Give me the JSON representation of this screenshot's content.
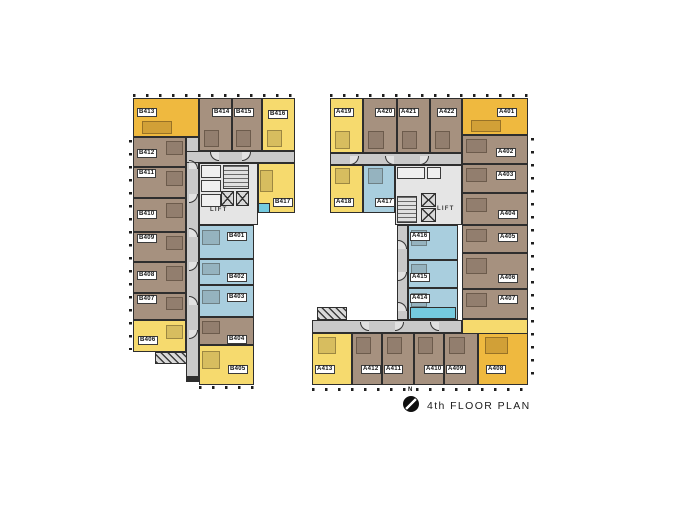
{
  "title": "4th FLOOR PLAN",
  "compass": {
    "label": "N"
  },
  "lift_label": "LIFT",
  "palette": {
    "amber": "#EFB93F",
    "yellow": "#F6DA6E",
    "brown": "#A6917F",
    "blue": "#A9CEDE",
    "cyan": "#74CADF",
    "corridor": "#C9C9C9",
    "core": "#E5E5E5",
    "wall": "#2E2E2E"
  },
  "buildings": [
    {
      "name": "b-wing",
      "corridors": [
        [
          186,
          137,
          13,
          245
        ],
        [
          186,
          151,
          109,
          12
        ]
      ],
      "rooms": [
        {
          "label": "B413",
          "color": "amber",
          "d": "b",
          "rect": [
            133,
            98,
            66,
            39
          ],
          "chip": [
            137,
            108
          ]
        },
        {
          "label": "B414",
          "color": "brown",
          "d": "b",
          "rect": [
            199,
            98,
            33,
            53
          ],
          "chip": [
            212,
            108
          ]
        },
        {
          "label": "B415",
          "color": "brown",
          "d": "b",
          "rect": [
            232,
            98,
            30,
            53
          ],
          "chip": [
            234,
            108
          ]
        },
        {
          "label": "B416",
          "color": "yellow",
          "d": "b",
          "rect": [
            262,
            98,
            33,
            53
          ],
          "chip": [
            268,
            110
          ]
        },
        {
          "label": "B417",
          "color": "yellow",
          "d": "l",
          "rect": [
            258,
            163,
            37,
            50
          ],
          "chip": [
            273,
            198
          ]
        },
        {
          "label": "B412",
          "color": "brown",
          "d": "r",
          "rect": [
            133,
            137,
            53,
            30
          ],
          "chip": [
            137,
            149
          ]
        },
        {
          "label": "B411",
          "color": "brown",
          "d": "r",
          "rect": [
            133,
            167,
            53,
            31
          ],
          "chip": [
            137,
            169
          ]
        },
        {
          "label": "B410",
          "color": "brown",
          "d": "r",
          "rect": [
            133,
            198,
            53,
            34
          ],
          "chip": [
            137,
            210
          ]
        },
        {
          "label": "B409",
          "color": "brown",
          "d": "r",
          "rect": [
            133,
            232,
            53,
            30
          ],
          "chip": [
            137,
            234
          ]
        },
        {
          "label": "B408",
          "color": "brown",
          "d": "r",
          "rect": [
            133,
            262,
            53,
            31
          ],
          "chip": [
            137,
            271
          ]
        },
        {
          "label": "B407",
          "color": "brown",
          "d": "r",
          "rect": [
            133,
            293,
            53,
            27
          ],
          "chip": [
            137,
            295
          ]
        },
        {
          "label": "B406",
          "color": "yellow",
          "d": "r",
          "rect": [
            133,
            320,
            53,
            32
          ],
          "chip": [
            138,
            336
          ]
        },
        {
          "label": "B401",
          "color": "blue",
          "d": "l",
          "rect": [
            199,
            225,
            55,
            34
          ],
          "chip": [
            227,
            232
          ]
        },
        {
          "label": "B402",
          "color": "blue",
          "d": "l",
          "rect": [
            199,
            259,
            55,
            26
          ],
          "chip": [
            227,
            273
          ]
        },
        {
          "label": "B403",
          "color": "blue",
          "d": "l",
          "rect": [
            199,
            285,
            55,
            32
          ],
          "chip": [
            227,
            293
          ]
        },
        {
          "label": "B404",
          "color": "brown",
          "d": "l",
          "rect": [
            199,
            317,
            55,
            28
          ],
          "chip": [
            227,
            335
          ]
        },
        {
          "label": "B405",
          "color": "yellow",
          "d": "l",
          "rect": [
            199,
            345,
            55,
            40
          ],
          "chip": [
            228,
            365
          ]
        }
      ],
      "cores": [
        {
          "rect": [
            199,
            163,
            59,
            62
          ],
          "rooms": [
            [
              201,
              165,
              20,
              13
            ],
            [
              201,
              180,
              20,
              12
            ],
            [
              201,
              194,
              20,
              13
            ]
          ],
          "stairs": [
            [
              223,
              165,
              26,
              24
            ]
          ],
          "lifts": [
            [
              221,
              191,
              13,
              15
            ],
            [
              236,
              191,
              13,
              15
            ]
          ],
          "lift_label_pos": [
            210,
            207
          ]
        }
      ],
      "decorations": [
        {
          "kind": "hatch",
          "rect": [
            155,
            352,
            32,
            12
          ]
        },
        {
          "kind": "cyan",
          "rect": [
            258,
            203,
            12,
            10
          ]
        },
        {
          "kind": "solid-dark",
          "rect": [
            186,
            376,
            13,
            6
          ]
        },
        {
          "kind": "ticks-v",
          "rect": [
            129,
            140,
            3,
            210
          ]
        },
        {
          "kind": "ticks-h",
          "rect": [
            133,
            94,
            162,
            3
          ]
        },
        {
          "kind": "ticks-h",
          "rect": [
            199,
            386,
            55,
            3
          ]
        },
        {
          "kind": "arc",
          "pos": [
            189,
            160
          ],
          "dir": "tr"
        },
        {
          "kind": "arc",
          "pos": [
            189,
            194
          ],
          "dir": "br"
        },
        {
          "kind": "arc",
          "pos": [
            189,
            228
          ],
          "dir": "tr"
        },
        {
          "kind": "arc",
          "pos": [
            189,
            262
          ],
          "dir": "br"
        },
        {
          "kind": "arc",
          "pos": [
            189,
            296
          ],
          "dir": "tr"
        },
        {
          "kind": "arc",
          "pos": [
            189,
            330
          ],
          "dir": "br"
        },
        {
          "kind": "arc",
          "pos": [
            210,
            152
          ],
          "dir": "bl"
        },
        {
          "kind": "arc",
          "pos": [
            242,
            152
          ],
          "dir": "br"
        }
      ]
    },
    {
      "name": "a-wing",
      "corridors": [
        [
          330,
          153,
          132,
          12
        ],
        [
          397,
          225,
          11,
          95
        ],
        [
          312,
          320,
          150,
          13
        ]
      ],
      "rooms": [
        {
          "label": "A419",
          "color": "yellow",
          "d": "b",
          "rect": [
            330,
            98,
            33,
            55
          ],
          "chip": [
            334,
            108
          ]
        },
        {
          "label": "A420",
          "color": "brown",
          "d": "b",
          "rect": [
            363,
            98,
            34,
            55
          ],
          "chip": [
            375,
            108
          ]
        },
        {
          "label": "A421",
          "color": "brown",
          "d": "b",
          "rect": [
            397,
            98,
            33,
            55
          ],
          "chip": [
            399,
            108
          ]
        },
        {
          "label": "A422",
          "color": "brown",
          "d": "b",
          "rect": [
            430,
            98,
            32,
            55
          ],
          "chip": [
            437,
            108
          ]
        },
        {
          "label": "A401",
          "color": "amber",
          "d": "b",
          "rect": [
            462,
            98,
            66,
            37
          ],
          "chip": [
            497,
            108
          ]
        },
        {
          "label": "A402",
          "color": "brown",
          "d": "l",
          "rect": [
            462,
            135,
            66,
            29
          ],
          "chip": [
            496,
            148
          ]
        },
        {
          "label": "A403",
          "color": "brown",
          "d": "l",
          "rect": [
            462,
            164,
            66,
            29
          ],
          "chip": [
            496,
            171
          ]
        },
        {
          "label": "A404",
          "color": "brown",
          "d": "l",
          "rect": [
            462,
            193,
            66,
            32
          ],
          "chip": [
            498,
            210
          ]
        },
        {
          "label": "A405",
          "color": "brown",
          "d": "l",
          "rect": [
            462,
            225,
            66,
            28
          ],
          "chip": [
            498,
            233
          ]
        },
        {
          "label": "A406",
          "color": "brown",
          "d": "l",
          "rect": [
            462,
            253,
            66,
            36
          ],
          "chip": [
            498,
            274
          ]
        },
        {
          "label": "A407",
          "color": "brown",
          "d": "l",
          "rect": [
            462,
            289,
            66,
            30
          ],
          "chip": [
            498,
            295
          ]
        },
        {
          "label": "A418",
          "color": "yellow",
          "d": "t",
          "rect": [
            330,
            165,
            33,
            48
          ],
          "chip": [
            334,
            198
          ]
        },
        {
          "label": "A417",
          "color": "blue",
          "d": "t",
          "rect": [
            363,
            165,
            32,
            48
          ],
          "chip": [
            375,
            198
          ]
        },
        {
          "label": "A416",
          "color": "blue",
          "d": "l",
          "rect": [
            408,
            225,
            50,
            35
          ],
          "chip": [
            410,
            232
          ]
        },
        {
          "label": "A415",
          "color": "blue",
          "d": "l",
          "rect": [
            408,
            260,
            50,
            28
          ],
          "chip": [
            410,
            273
          ]
        },
        {
          "label": "A414",
          "color": "blue",
          "d": "l",
          "rect": [
            408,
            288,
            50,
            32
          ],
          "chip": [
            410,
            294
          ]
        },
        {
          "label": "A413",
          "color": "yellow",
          "d": "t",
          "rect": [
            312,
            333,
            40,
            52
          ],
          "chip": [
            315,
            365
          ]
        },
        {
          "label": "A412",
          "color": "brown",
          "d": "t",
          "rect": [
            352,
            333,
            30,
            52
          ],
          "chip": [
            361,
            365
          ]
        },
        {
          "label": "A411",
          "color": "brown",
          "d": "t",
          "rect": [
            382,
            333,
            32,
            52
          ],
          "chip": [
            384,
            365
          ]
        },
        {
          "label": "A410",
          "color": "brown",
          "d": "t",
          "rect": [
            414,
            333,
            30,
            52
          ],
          "chip": [
            424,
            365
          ]
        },
        {
          "label": "A409",
          "color": "brown",
          "d": "t",
          "rect": [
            444,
            333,
            34,
            52
          ],
          "chip": [
            446,
            365
          ]
        },
        {
          "label": "A408",
          "color": "amber",
          "d": "t",
          "rect": [
            478,
            333,
            50,
            52
          ],
          "chip": [
            486,
            365
          ]
        }
      ],
      "cores": [
        {
          "rect": [
            395,
            165,
            67,
            60
          ],
          "rooms": [
            [
              397,
              167,
              28,
              12
            ],
            [
              427,
              167,
              14,
              12
            ]
          ],
          "stairs": [
            [
              397,
              196,
              20,
              27
            ]
          ],
          "lifts": [
            [
              421,
              193,
              15,
              14
            ],
            [
              421,
              208,
              15,
              14
            ]
          ],
          "lift_label_pos": [
            437,
            206
          ]
        }
      ],
      "decorations": [
        {
          "kind": "hatch",
          "rect": [
            317,
            307,
            30,
            13
          ]
        },
        {
          "kind": "fill-yellow",
          "rect": [
            462,
            319,
            66,
            15
          ]
        },
        {
          "kind": "cyan",
          "rect": [
            410,
            307,
            46,
            12
          ]
        },
        {
          "kind": "ticks-v",
          "rect": [
            531,
            138,
            3,
            245
          ]
        },
        {
          "kind": "ticks-h",
          "rect": [
            330,
            94,
            198,
            3
          ]
        },
        {
          "kind": "ticks-h",
          "rect": [
            312,
            388,
            216,
            3
          ]
        },
        {
          "kind": "arc",
          "pos": [
            350,
            156
          ],
          "dir": "br"
        },
        {
          "kind": "arc",
          "pos": [
            385,
            156
          ],
          "dir": "bl"
        },
        {
          "kind": "arc",
          "pos": [
            420,
            156
          ],
          "dir": "br"
        },
        {
          "kind": "arc",
          "pos": [
            398,
            240
          ],
          "dir": "tr"
        },
        {
          "kind": "arc",
          "pos": [
            398,
            272
          ],
          "dir": "br"
        },
        {
          "kind": "arc",
          "pos": [
            398,
            302
          ],
          "dir": "tr"
        },
        {
          "kind": "arc",
          "pos": [
            360,
            322
          ],
          "dir": "bl"
        },
        {
          "kind": "arc",
          "pos": [
            395,
            322
          ],
          "dir": "br"
        },
        {
          "kind": "arc",
          "pos": [
            430,
            322
          ],
          "dir": "bl"
        }
      ]
    }
  ]
}
